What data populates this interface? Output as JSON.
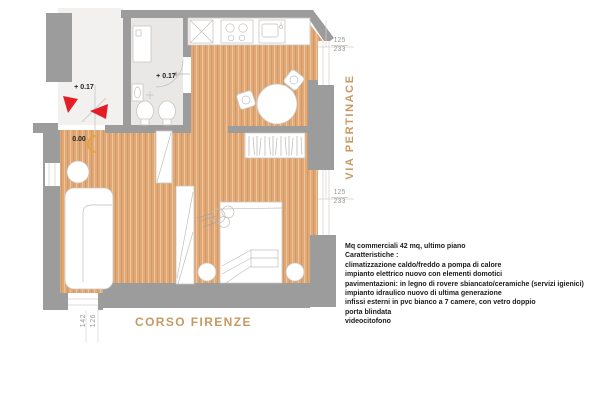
{
  "plan": {
    "streets": {
      "right": "VIA PERTINACE",
      "bottom": "CORSO FIRENZE"
    },
    "levels": {
      "stair": "+ 0.17",
      "bath": "+ 0.17",
      "entry": "0.00"
    },
    "dimensions": {
      "right_top": [
        "125",
        "233"
      ],
      "right_bottom": [
        "125",
        "233"
      ],
      "bottom_left": [
        "142",
        "126"
      ]
    },
    "description": {
      "lines": [
        "Mq commerciali 42 mq, ultimo piano",
        "Caratteristiche :",
        "climatizzazione caldo/freddo a pompa di calore",
        "impianto elettrico nuovo con elementi domotici",
        "pavimentazioni: in legno di rovere sbiancato/ceramiche (servizi igienici)",
        "impianto idraulico nuovo di ultima generazione",
        "infissi esterni in pvc bianco a 7 camere, con vetro doppio",
        "porta blindata",
        "videocitofono"
      ]
    },
    "colors": {
      "wood": "#e2aa77",
      "wall": "#9c9c9c",
      "bath_floor": "#e9e8e6",
      "stair_floor": "#f2f1ef",
      "street_text": "#c69a63",
      "arrow_red": "#e41e25",
      "door_orange": "#e8a33d"
    }
  }
}
